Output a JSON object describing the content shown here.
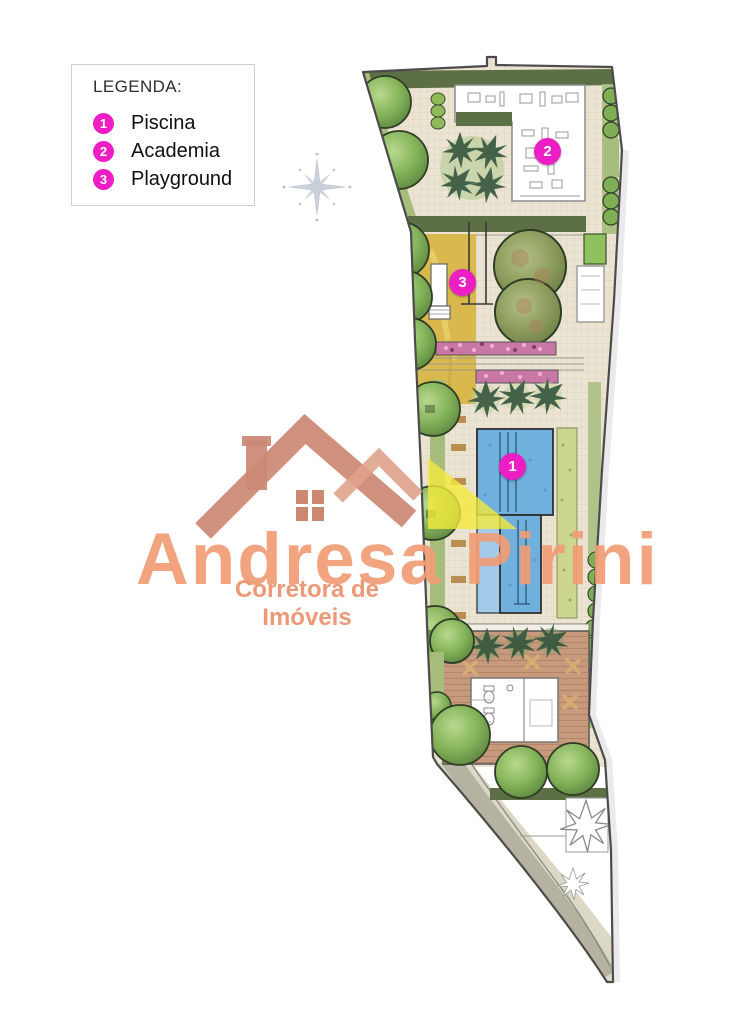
{
  "legend": {
    "title": "LEGENDA:",
    "items": [
      {
        "number": "1",
        "label": "Piscina"
      },
      {
        "number": "2",
        "label": "Academia"
      },
      {
        "number": "3",
        "label": "Playground"
      }
    ]
  },
  "plan": {
    "markers": [
      {
        "number": "1",
        "name": "piscina"
      },
      {
        "number": "2",
        "name": "academia"
      },
      {
        "number": "3",
        "name": "playground"
      }
    ]
  },
  "logo": {
    "name": "Andresa Pirini",
    "tagline": "Corretora de Imóveis"
  },
  "colors": {
    "marker_magenta": "#ec1ec4",
    "logo_salmon_text": "#f09c74",
    "logo_roof": "#cb8974",
    "logo_yellow": "#f2e83c",
    "pool_blue": "#6fb0dd",
    "sand_yellow": "#d9b94d",
    "deck_wood": "#c79a7d",
    "hedge_dark": "#5c6f45"
  }
}
